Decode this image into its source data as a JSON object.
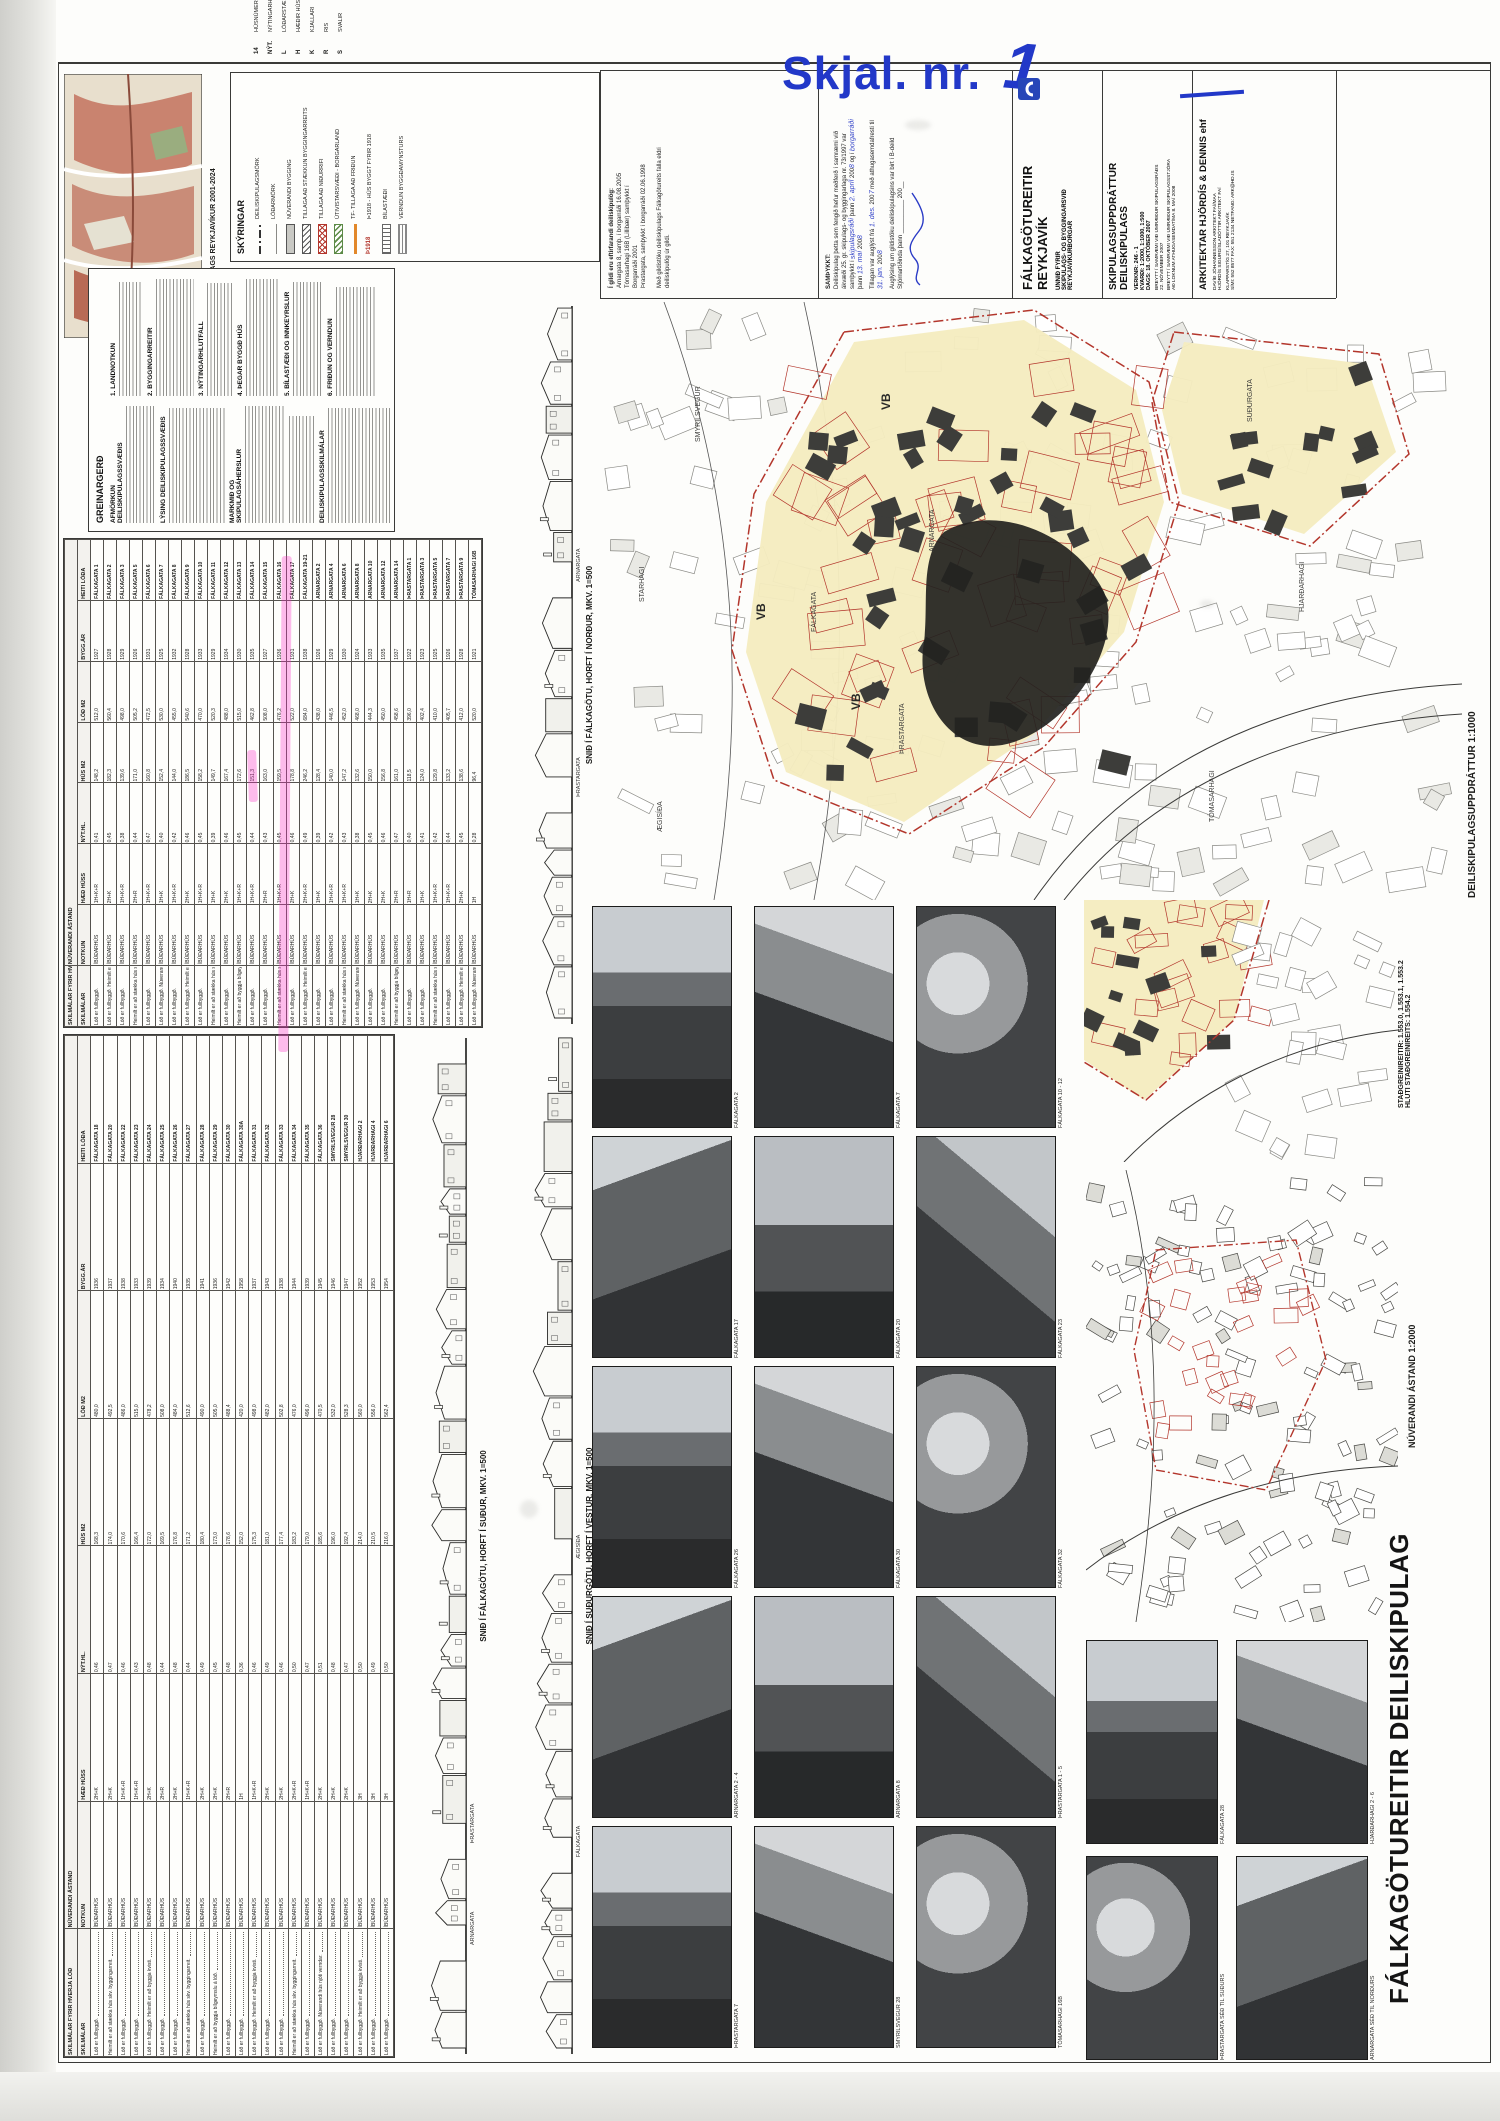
{
  "colors": {
    "accent_blue": "#2238c8",
    "map_yellow": "#f5ecc0",
    "plan_red": "#b3362c",
    "highlight_pink": "#fc2ec6",
    "green": "#5c8a46",
    "orange": "#e2882a"
  },
  "stamp": {
    "label": "Skjal. nr.",
    "number": "1"
  },
  "inset": {
    "label": "HLUTI AÐALSKIPULAGS REYKJAVÍKUR  2001-2024"
  },
  "legend": {
    "heading": "SKÝRINGAR",
    "items": [
      {
        "label": "DEILISKIPULAGSMÖRK",
        "type": "dashdot"
      },
      {
        "label": "LÓÐARMÖRK",
        "type": "line"
      },
      {
        "label": "NÚVERANDI BYGGING",
        "type": "grayfill"
      },
      {
        "label": "TILLAGA AÐ STÆKKUN BYGGINGARREITS",
        "type": "hatch"
      },
      {
        "label": "TILLAGA AÐ NIÐURRIFI",
        "type": "crosshatch"
      },
      {
        "label": "ÚTIVISTARSVÆÐI - BORGARLAND",
        "type": "greenhatch"
      },
      {
        "label": "TF- TILLAGA AÐ FRIÐUN",
        "type": "orange"
      },
      {
        "label": "Þ1918 - HÚS BYGGT FYRIR 1918",
        "type": "red1918"
      },
      {
        "label": "BÍLASTÆÐI",
        "type": "parking"
      },
      {
        "label": "VERNDUN BYGGÐAMYNSTURS",
        "type": "pattern"
      }
    ],
    "key": [
      {
        "sym": "14",
        "label": "HÚSNÚMER"
      },
      {
        "sym": "NÝT.",
        "label": "NÝTINGARHLUTFALL"
      },
      {
        "sym": "L",
        "label": "LÓÐARSTÆRÐ Í M2"
      },
      {
        "sym": "H",
        "label": "HÆÐIR HÚSA (FJÖLDI)"
      },
      {
        "sym": "K",
        "label": "KJALLARI"
      },
      {
        "sym": "R",
        "label": "RIS"
      },
      {
        "sym": "S",
        "label": "SVALIR"
      }
    ]
  },
  "report": {
    "title": "GREINARGERÐ",
    "sections": [
      "AFMÖRKUN DEILISKIPULAGSSVÆÐIS",
      "LÝSING DEILISKIPULAGSSVÆÐIS",
      "MARKMIÐ OG SKIPULAGSÁHERSLUR",
      "DEILISKIPULAGSSKILMÁLAR"
    ],
    "subs": [
      "1. LANDNOTKUN",
      "2. BYGGINGARREITIR",
      "3. NÝTINGARHLUTFALL",
      "4. ÞEGAR BYGGÐ HÚS",
      "5. BÍLASTÆÐI OG INNKEYRSLUR",
      "6. FRIÐUN OG VERNDUN"
    ]
  },
  "titleblock": {
    "validity": {
      "lines": [
        "Í gildi eru eftirfarandi deiliskipulög:",
        "Arnargata 8, samþ. í borgarráði 16.08.2005",
        "Tómasarhagi 16B (Lillibær) samþykkt í",
        "Borgarráði 2001",
        "Þrastargata, samþykkt í borgarráði 02.06.1998"
      ],
      "note": "Með gildistöku deiliskipulags Fálkagötureits falla eldri deiliskipulög úr gildi."
    },
    "approval": {
      "heading": "SAMÞYKKT:",
      "body1": "Deiliskipulag þetta sem fengið hefur meðferð í samræmi við ákvæði 25. gr. skipulags- og byggingarlaga nr. 73/1997 var samþykkt í",
      "hw_board1": "skipulagsráði",
      "word_thann": "þann",
      "hw_date1": "2. apríl",
      "y200": "200",
      "hw_y1": "8",
      "word_ogi": "og í",
      "hw_board2": "borgarráði",
      "hw_date2": "13. maí",
      "hw_y2": "8",
      "body2": "Tillagan var auglýst frá",
      "hw_date3": "1. des.",
      "hw_y3": "7",
      "body3": "með athugasemdafresti til",
      "hw_date4": "31. jan.",
      "hw_y4": "8",
      "body4": "Auglýsing um gildistöku deiliskipulagsins var birt í B-deild Stjórnartíðinda þann",
      "blank": "__________",
      "y290": "200__"
    },
    "firm": {
      "project": "FÁLKAGÖTUREITIR",
      "city": "REYKJAVÍK",
      "client1": "UNNIÐ FYRIR",
      "client2": "SKIPULAGS- OG BYGGINGARSVIÐ",
      "client3": "REYKJAVÍKURBORGAR"
    },
    "sheet": {
      "title1": "SKIPULAGSUPPDRÁTTUR",
      "title2": "DEILISKIPULAGS",
      "verknr": "VERKNR: 246 - 1",
      "kvardi": "KVARÐI: 1:2000, 1:1000, 1:500",
      "dags": "DAGS: 18. OKTÓBER 2007",
      "rev1": "BREYTT Í SAMRÆMI VIÐ UMRÆÐUR SKIPULAGSRÁÐS",
      "rev1b": "22. NÓVEMBER 2007",
      "rev2": "BREYTT Í SAMRÆMI VIÐ UMRÆÐUR SKIPULAGSSTJÓRA",
      "rev2b": "AÐ LOKNUM ATHUGASEMDATÍMA 8. MAÍ 2008"
    },
    "architects": {
      "name": "ARKITEKTAR HJÖRDÍS & DENNIS ehf",
      "line1": "DAVÍÐ JÓHANNESSON ARKITEKT FAÍ/MAA",
      "line2": "HJÖRDÍS SIGURGÍSLADÓTTIR ARKITEKT FAÍ",
      "line3": "KLAPPARSTÍG 27, 101 REYKJAVÍK",
      "line4": "SÍMI: 552 8577  FAX: 551 2134  NETFANG: ARK@HD.IS"
    }
  },
  "mainmap": {
    "label": "DEILISKIPULAGSUPPDRÁTTUR    1:1000",
    "vb": "VB",
    "streets": [
      "FÁLKAGATA",
      "ARNARGATA",
      "ÞRASTARGATA",
      "SMYRILSVEGUR",
      "TÓMASARHAGI",
      "HJARÐARHAGI",
      "SUÐURGATA",
      "ÆGISÍÐA",
      "STARHAGI"
    ]
  },
  "stadgrein": {
    "line1": "STAÐGREINIREITIR: 1.553.0, 1.553.1, 1.553.2",
    "line2": "HLUTI STAÐGREINIREITS: 1.554.2"
  },
  "overview2000": {
    "label": "NÚVERANDI ÁSTAND    1:2000"
  },
  "maintitle": {
    "text": "FÁLKAGÖTUREITIR  DEILISKIPULAG"
  },
  "sections": {
    "labels": [
      "SNIÐ Í FÁLKAGÖTU, HORFT Í NORÐUR, MKV. 1=500",
      "SNIÐ Í FÁLKAGÖTU, HORFT Í SUÐUR, MKV. 1=500",
      "SNIÐ Í SUÐURGÖTU, HORFT Í VESTUR, MKV. 1=500"
    ],
    "streets": [
      [
        "ÞRASTARGATA",
        "ARNARGATA",
        "SMYRILSVEGUR"
      ],
      [
        "ARNARGATA",
        "ÞRASTARGATA"
      ],
      [
        "FÁLKAGATA",
        "ÆGISÍÐA"
      ]
    ]
  },
  "tables": {
    "group_existing": "NÚVERANDI ÁSTAND",
    "group_terms": "SKILMÁLAR FYRIR HVERJA LÓÐ",
    "columns": [
      "SKILMÁLAR",
      "NOTKUN",
      "HÆÐ HÚSS",
      "NÝT.HL.",
      "HÚS M2",
      "LÓÐ M2",
      "BYGG.ÁR",
      "HEITI LÓÐA"
    ],
    "notkun_default": "ÍBÚÐARHÚS",
    "terms_phrases": [
      "Lóð er fullbyggð.",
      "Lóð er fullbyggð. Heimilt er að byggja kvisti.",
      "Heimilt er að stækka hús skv. byggingarreit.",
      "Lóð er fullbyggð. Núverandi hús njóti verndar.",
      "Heimilt er að byggja bílgeymslu á lóð."
    ],
    "upper_rows": [
      [
        "FÁLKAGATA 1",
        "1927",
        "512,0",
        "148,2",
        "0,41",
        "1H+K+R",
        0
      ],
      [
        "FÁLKAGATA 2",
        "1928",
        "560,4",
        "182,3",
        "0,45",
        "2H+K",
        1
      ],
      [
        "FÁLKAGATA 3",
        "1929",
        "498,0",
        "139,6",
        "0,38",
        "1H+K+R",
        0
      ],
      [
        "FÁLKAGATA 5",
        "1926",
        "505,2",
        "171,0",
        "0,44",
        "2H+R",
        2
      ],
      [
        "FÁLKAGATA 6",
        "1931",
        "472,5",
        "160,8",
        "0,47",
        "1H+K+R",
        0
      ],
      [
        "FÁLKAGATA 7",
        "1925",
        "530,0",
        "152,4",
        "0,40",
        "1H+K",
        3
      ],
      [
        "FÁLKAGATA 8",
        "1932",
        "455,0",
        "144,0",
        "0,42",
        "1H+K+R",
        0
      ],
      [
        "FÁLKAGATA 9",
        "1928",
        "540,6",
        "186,5",
        "0,46",
        "2H+K",
        1
      ],
      [
        "FÁLKAGATA 10",
        "1933",
        "470,0",
        "158,2",
        "0,45",
        "1H+K+R",
        0
      ],
      [
        "FÁLKAGATA 11",
        "1929",
        "520,3",
        "149,7",
        "0,39",
        "1H+K",
        2
      ],
      [
        "FÁLKAGATA 12",
        "1934",
        "488,0",
        "167,4",
        "0,46",
        "2H+K",
        0
      ],
      [
        "FÁLKAGATA 13",
        "1930",
        "515,0",
        "172,6",
        "0,45",
        "1H+K+R",
        4
      ],
      [
        "FÁLKAGATA 14",
        "1935",
        "462,8",
        "151,3",
        "0,44",
        "1H+K+R",
        0
      ],
      [
        "FÁLKAGATA 15",
        "1927",
        "508,0",
        "163,0",
        "0,43",
        "2H+R",
        0
      ],
      [
        "FÁLKAGATA 16",
        "1936",
        "476,2",
        "159,5",
        "0,45",
        "1H+K+R",
        2
      ],
      [
        "FÁLKAGATA 17",
        "1931",
        "522,0",
        "178,8",
        "0,46",
        "2H+K",
        0
      ],
      [
        "FÁLKAGATA 19-21",
        "1938",
        "684,0",
        "246,2",
        "0,49",
        "2H+K+R",
        1
      ],
      [
        "ARNARGATA 2",
        "1926",
        "438,0",
        "128,4",
        "0,39",
        "1H+K",
        0
      ],
      [
        "ARNARGATA 4",
        "1929",
        "446,5",
        "140,0",
        "0,42",
        "1H+K+R",
        0
      ],
      [
        "ARNARGATA 6",
        "1930",
        "452,0",
        "147,2",
        "0,43",
        "1H+K+R",
        2
      ],
      [
        "ARNARGATA 8",
        "1924",
        "468,0",
        "132,6",
        "0,38",
        "1H+K",
        3
      ],
      [
        "ARNARGATA 10",
        "1933",
        "444,3",
        "150,0",
        "0,45",
        "2H+K",
        0
      ],
      [
        "ARNARGATA 12",
        "1935",
        "450,0",
        "156,8",
        "0,46",
        "2H+K",
        0
      ],
      [
        "ARNARGATA 14",
        "1937",
        "458,6",
        "161,0",
        "0,47",
        "2H+R",
        4
      ],
      [
        "ÞRASTARGATA 1",
        "1922",
        "396,0",
        "118,5",
        "0,40",
        "1H+R",
        0
      ],
      [
        "ÞRASTARGATA 3",
        "1923",
        "402,4",
        "124,0",
        "0,41",
        "1H+K",
        0
      ],
      [
        "ÞRASTARGATA 5",
        "1925",
        "410,0",
        "129,8",
        "0,42",
        "1H+K+R",
        2
      ],
      [
        "ÞRASTARGATA 7",
        "1926",
        "405,7",
        "133,2",
        "0,44",
        "1H+K+R",
        0
      ],
      [
        "ÞRASTARGATA 9",
        "1928",
        "412,0",
        "138,6",
        "0,45",
        "2H+K",
        1
      ],
      [
        "TÓMASARHAGI 16B",
        "1921",
        "520,0",
        "96,4",
        "0,28",
        "1H",
        3
      ]
    ],
    "lower_rows": [
      [
        "FÁLKAGATA 18",
        "1936",
        "480,0",
        "168,3",
        "0,46",
        "2H+K",
        0
      ],
      [
        "FÁLKAGATA 20",
        "1937",
        "492,5",
        "174,0",
        "0,47",
        "2H+K",
        2
      ],
      [
        "FÁLKAGATA 22",
        "1938",
        "486,0",
        "170,6",
        "0,46",
        "1H+K+R",
        0
      ],
      [
        "FÁLKAGATA 23",
        "1933",
        "515,0",
        "166,4",
        "0,43",
        "1H+K+R",
        0
      ],
      [
        "FÁLKAGATA 24",
        "1939",
        "478,2",
        "172,0",
        "0,48",
        "2H+K",
        1
      ],
      [
        "FÁLKAGATA 25",
        "1934",
        "508,0",
        "169,5",
        "0,44",
        "2H+R",
        0
      ],
      [
        "FÁLKAGATA 26",
        "1940",
        "484,0",
        "176,8",
        "0,48",
        "2H+K",
        0
      ],
      [
        "FÁLKAGATA 27",
        "1935",
        "512,6",
        "171,2",
        "0,44",
        "1H+K+R",
        2
      ],
      [
        "FÁLKAGATA 28",
        "1941",
        "490,0",
        "180,4",
        "0,49",
        "2H+K",
        0
      ],
      [
        "FÁLKAGATA 29",
        "1936",
        "505,0",
        "173,0",
        "0,45",
        "2H+K",
        4
      ],
      [
        "FÁLKAGATA 30",
        "1942",
        "488,4",
        "178,6",
        "0,48",
        "2H+R",
        0
      ],
      [
        "FÁLKAGATA 30A",
        "1958",
        "420,0",
        "152,0",
        "0,36",
        "1H",
        0
      ],
      [
        "FÁLKAGATA 31",
        "1937",
        "498,0",
        "175,3",
        "0,46",
        "1H+K+R",
        1
      ],
      [
        "FÁLKAGATA 32",
        "1943",
        "482,0",
        "181,0",
        "0,49",
        "2H+K",
        0
      ],
      [
        "FÁLKAGATA 33",
        "1938",
        "502,8",
        "177,4",
        "0,46",
        "2H+K",
        0
      ],
      [
        "FÁLKAGATA 34",
        "1944",
        "476,0",
        "183,2",
        "0,50",
        "2H+K+R",
        2
      ],
      [
        "FÁLKAGATA 35",
        "1939",
        "496,0",
        "179,0",
        "0,47",
        "1H+K+R",
        0
      ],
      [
        "FÁLKAGATA 36",
        "1945",
        "470,5",
        "185,6",
        "0,51",
        "2H+K",
        3
      ],
      [
        "SMYRILSVEGUR 28",
        "1946",
        "532,0",
        "196,0",
        "0,48",
        "2H+K",
        0
      ],
      [
        "SMYRILSVEGUR 30",
        "1947",
        "528,3",
        "192,4",
        "0,47",
        "2H+K",
        0
      ],
      [
        "HJARÐARHAGI 2",
        "1952",
        "560,0",
        "214,0",
        "0,50",
        "3H",
        1
      ],
      [
        "HJARÐARHAGI 4",
        "1953",
        "556,0",
        "210,5",
        "0,49",
        "3H",
        0
      ],
      [
        "HJARÐARHAGI 6",
        "1954",
        "562,4",
        "216,0",
        "0,50",
        "3H",
        0
      ]
    ]
  },
  "photos": {
    "left_captions": [
      "FÁLKAGATA 2",
      "FÁLKAGATA 7",
      "FÁLKAGATA 10 - 12",
      "FÁLKAGATA 17",
      "FÁLKAGATA 20",
      "FÁLKAGATA 23",
      "FÁLKAGATA 26",
      "FÁLKAGATA 30",
      "FÁLKAGATA 32",
      "ARNARGATA 2 - 4",
      "ARNARGATA 8",
      "ÞRASTARGATA 1 - 5",
      "ÞRASTARGATA 7",
      "SMYRILSVEGUR 28",
      "TÓMASARHAGI 16B"
    ],
    "right_captions": [
      "FÁLKAGATA 28",
      "HJARÐARHAGI 2 - 6",
      "ÞRASTARGATA SÉÐ TIL SUÐURS",
      "ARNARGATA SÉÐ TIL NORÐURS"
    ]
  }
}
